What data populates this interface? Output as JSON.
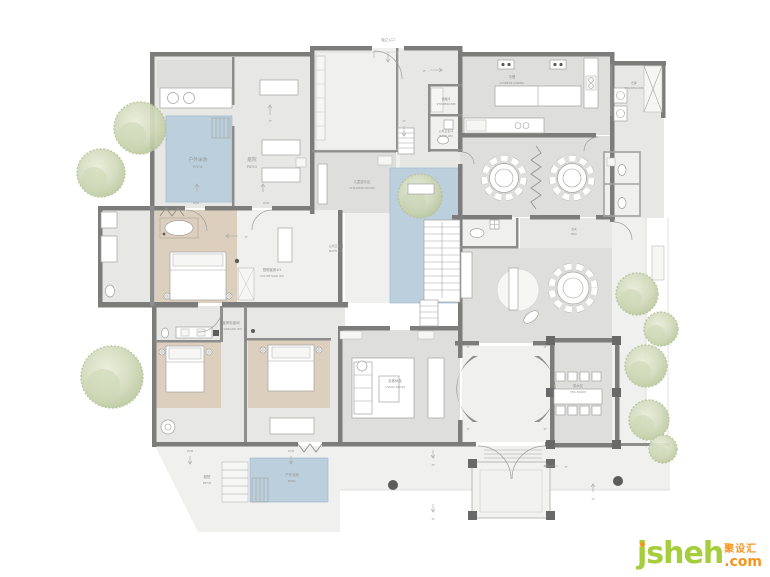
{
  "plan": {
    "type": "residential floor plan",
    "labels": {
      "entrance": {
        "zh": "独立入口"
      },
      "pool_top": {
        "zh": "户外泳池",
        "en": "POOL"
      },
      "patio_top": {
        "zh": "庭院",
        "en": "PATIO"
      },
      "children_room": {
        "zh": "儿童游乐区",
        "en": "CHILDREN ROOM"
      },
      "storeroom_mid": {
        "zh": "储藏间",
        "en": "STOREROOM"
      },
      "bath_mid": {
        "zh": "公共卫生间",
        "en": "BATH RM"
      },
      "chinese_dining": {
        "zh": "中餐",
        "en": "CHINESE DINING"
      },
      "storeroom_right": {
        "zh": "仓库",
        "en": "STOREROOM"
      },
      "bath_center": {
        "zh": "公共卫生间",
        "en": "BATH RM"
      },
      "courtyard_room": {
        "zh": "庭院客房#1",
        "en": "COURTYARD RM"
      },
      "standard_room": {
        "zh": "客房标准间",
        "en": "STANDARD RM"
      },
      "hall_box": {
        "zh": "玄关",
        "en": "BOX"
      },
      "living_room": {
        "zh": "会客休息",
        "en": "LIVING ROOM"
      },
      "tea_room": {
        "zh": "茶水区",
        "en": "TEA ROOM"
      },
      "patio_bottom": {
        "zh": "庭院",
        "en": "PATIO"
      },
      "pool_bottom": {
        "zh": "户外泳池",
        "en": "POOL"
      }
    },
    "markers": {
      "level": "1F",
      "window": "W/M"
    }
  },
  "watermark": {
    "brand": "jsheh",
    "zh": "聚设汇",
    "tld": ".com"
  },
  "colors": {
    "wall": "#7c7c7a",
    "floor": "#e7e7e5",
    "floor_dark": "#dededc",
    "wood": "#dccfbd",
    "pool": "#bccfdd",
    "tree": "#ccd6b8",
    "label": "#8f8f8d",
    "brand_green": "#a6cd3c",
    "brand_orange": "#f7941e"
  }
}
